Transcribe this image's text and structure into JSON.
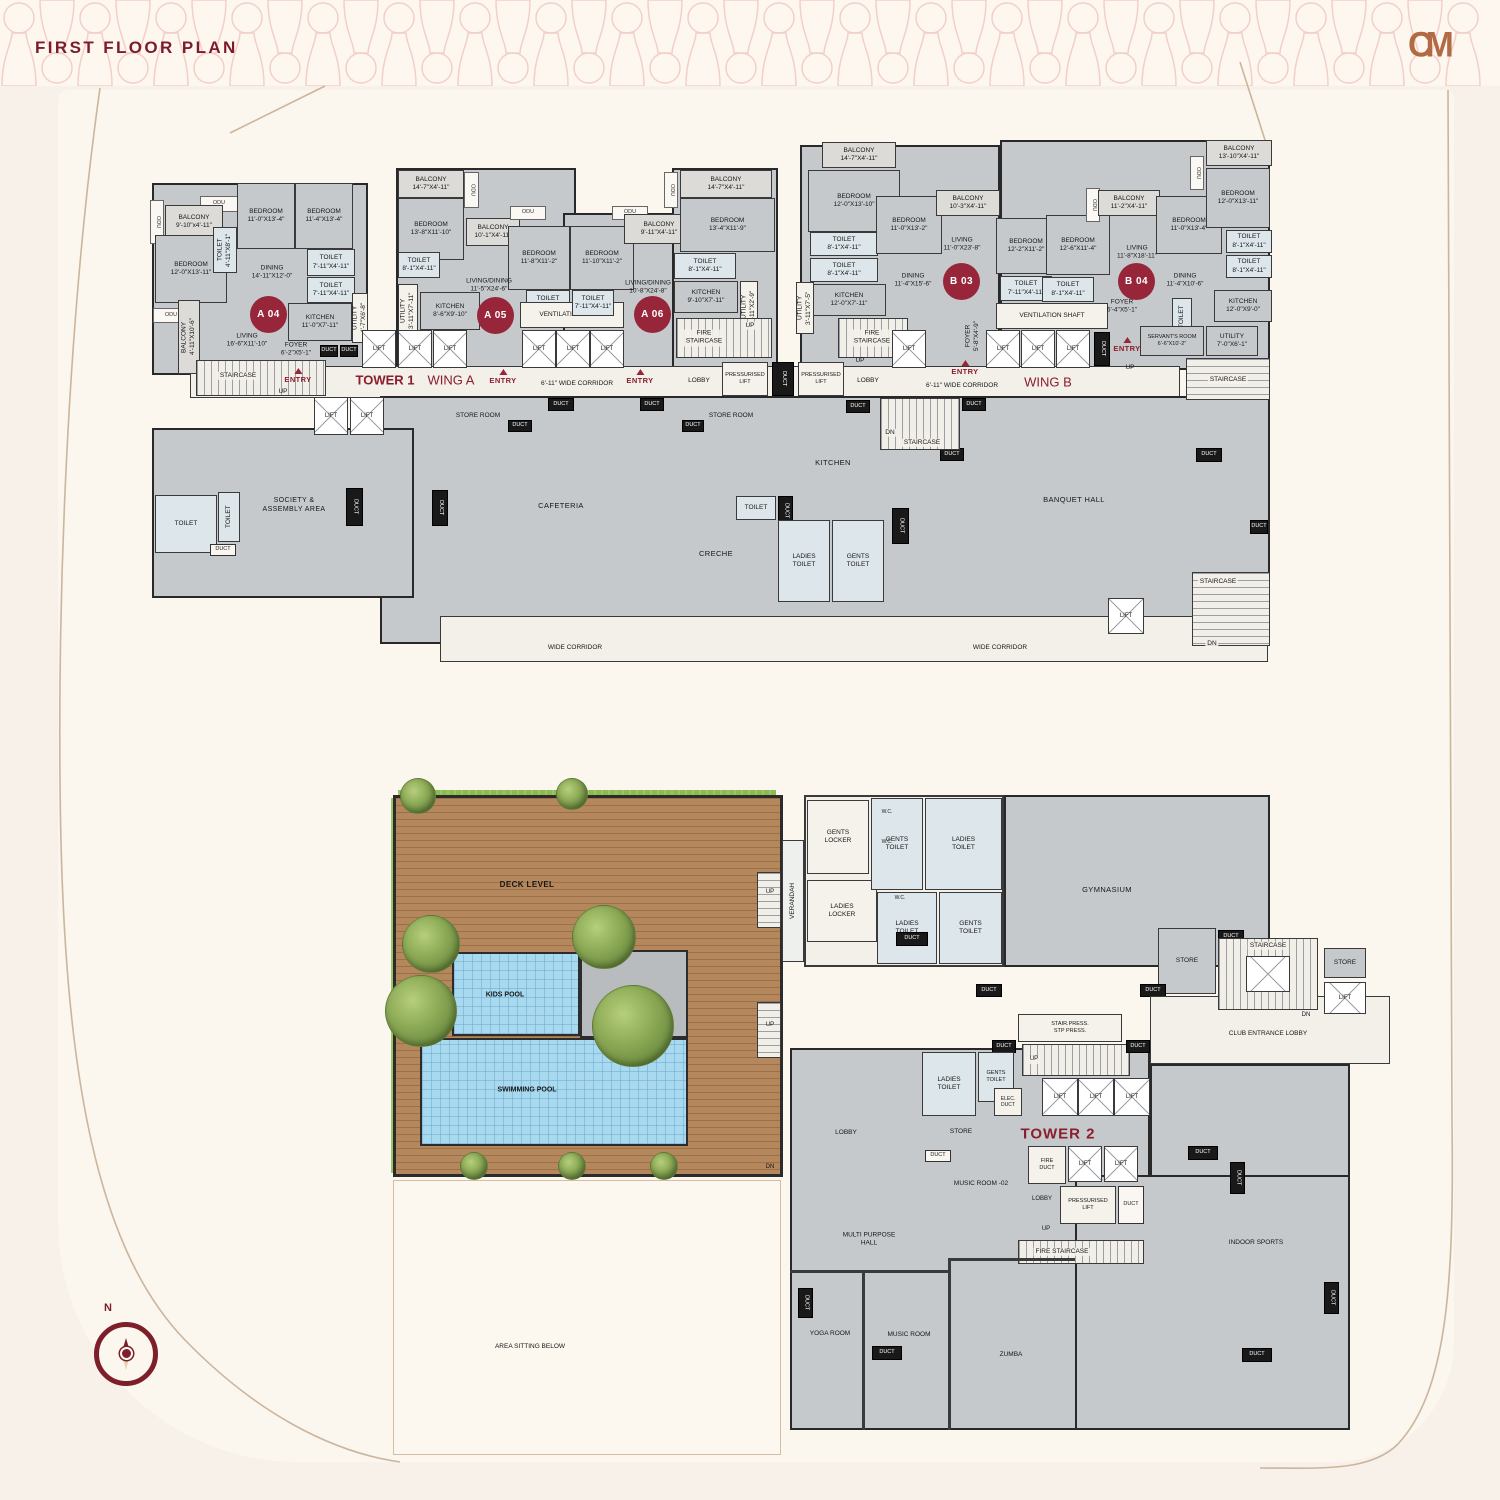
{
  "hdr": {
    "title": "FIRST FLOOR PLAN",
    "logo": "CM"
  },
  "badge": {
    "a04": "A 04",
    "a05": "A 05",
    "a06": "A 06",
    "b03": "B 03",
    "b04": "B 04"
  },
  "com": {
    "lift": "LIFT",
    "duct": "DUCT",
    "odu": "ODU",
    "entry": "ENTRY",
    "up": "UP",
    "dn": "DN",
    "staircase": "STAIRCASE",
    "toilet": "TOILET",
    "wc": "W.C.",
    "store": "STORE",
    "lobby": "LOBBY"
  },
  "t1": {
    "tower": "TOWER 1",
    "wing_a": "WING A",
    "wing_b": "WING B",
    "corridor": "6'-11\" WIDE CORRIDOR",
    "wide_corridor": "WIDE CORRIDOR",
    "vent": "VENTILATION SHAFT",
    "fire_stair": "FIRE\nSTAIRCASE",
    "press_lift": "PRESSURISED\nLIFT",
    "soc": "SOCIETY &\nASSEMBLY AREA",
    "store_room": "STORE ROOM",
    "cafeteria": "CAFETERIA",
    "kitchen": "KITCHEN",
    "creche": "CRECHE",
    "ladies_toilet": "LADIES\nTOILET",
    "gents_toilet": "GENTS\nTOILET",
    "banquet": "BANQUET HALL",
    "a04": {
      "bal1": "BALCONY\n9'-10\"x4'-11\"",
      "bed1": "BEDROOM\n11'-0\"X13'-4\"",
      "bed2": "BEDROOM\n11'-4\"X13'-4\"",
      "bed3": "BEDROOM\n12'-0\"X13'-11\"",
      "t1": "TOILET\n4'-11\"X8'-1\"",
      "t2": "TOILET\n7'-11\"X4'-11\"",
      "t3": "TOILET\n7'-11\"X4'-11\"",
      "dining": "DINING\n14'-11\"X12'-0\"",
      "kitchen": "KITCHEN\n11'-0\"X7'-11\"",
      "living": "LIVING\n16'-6\"X11'-10\"",
      "foyer": "FOYER\n6'-2\"X5'-1\"",
      "utility": "UTILITY\n4'-7\"X6'-8\"",
      "bal2": "BALCONY\n4'-11\"X10'-6\""
    },
    "a05": {
      "bal1": "BALCONY\n14'-7\"X4'-11\"",
      "bed1": "BEDROOM\n13'-8\"X11'-10\"",
      "t1": "TOILET\n8'-1\"X4'-11\"",
      "bal2": "BALCONY\n10'-1\"X4'-11\"",
      "bed2": "BEDROOM\n11'-8\"X11'-2\"",
      "t2": "TOILET\n7'-11\"X4'-11\"",
      "ld": "LIVING/DINING\n11'-5\"X24'-6\"",
      "kitchen": "KITCHEN\n8'-6\"X9'-10\"",
      "utility": "UTILITY\n3'-11\"X7'-11\""
    },
    "a06": {
      "bed1": "BEDROOM\n11'-10\"X11'-2\"",
      "t1": "TOILET\n7'-11\"X4'-11\"",
      "bal1": "BALCONY\n9'-11\"X4'-11\"",
      "ld": "LIVING/DINING\n10'-8\"X24'-8\"",
      "kitchen": "KITCHEN\n9'-10\"X7'-11\"",
      "t2": "TOILET\n8'-1\"X4'-11\"",
      "utility": "UTILITY\n3'-11\"X2'-9\"",
      "bal2": "BALCONY\n14'-7\"X4'-11\"",
      "bed2": "BEDROOM\n13'-4\"X11'-9\""
    },
    "b03": {
      "bal1": "BALCONY\n14'-7\"X4'-11\"",
      "bed1": "BEDROOM\n12'-0\"X13'-10\"",
      "t1": "TOILET\n8'-1\"X4'-11\"",
      "t2": "TOILET\n8'-1\"X4'-11\"",
      "kitchen": "KITCHEN\n12'-0\"X7'-11\"",
      "utility": "UTILITY\n3'-11\"X7'-5\"",
      "bed2": "BEDROOM\n11'-0\"X13'-2\"",
      "dining": "DINING\n11'-4\"X15'-6\"",
      "living": "LIVING\n11'-0\"X23'-8\"",
      "bal2": "BALCONY\n10'-3\"X4'-11\"",
      "foyer": "FOYER\n5'-8\"X4'-9\"",
      "bed3": "BEDROOM\n12'-2\"X11'-2\"",
      "t3": "TOILET\n7'-11\"X4'-11\""
    },
    "b04": {
      "bed1": "BEDROOM\n12'-6\"X11'-4\"",
      "t1": "TOILET\n8'-1\"X4'-11\"",
      "bal1": "BALCONY\n11'-2\"X4'-11\"",
      "living": "LIVING\n11'-8\"X18'-11\"",
      "bed3": "BEDROOM\n11'-0\"X13'-4\"",
      "dining": "DINING\n11'-4\"X10'-6\"",
      "foyer": "FOYER\n6'-4\"X5'-1\"",
      "bal2": "BALCONY\n13'-10\"X4'-11\"",
      "bed4": "BEDROOM\n12'-0\"X13'-11\"",
      "t3": "TOILET\n8'-1\"X4'-11\"",
      "t4": "TOILET\n8'-1\"X4'-11\"",
      "kitchen": "KITCHEN\n12'-0\"X9'-0\"",
      "servant": "SERVANT'S ROOM\n6'-6\"X10'-2\"",
      "utility": "UTILITY\n7'-0\"X6'-1\""
    }
  },
  "am": {
    "deck": "DECK LEVEL",
    "kids_pool": "KIDS  POOL",
    "swimming_pool": "SWIMMING  POOL",
    "verandah": "VERANDAH",
    "gents_locker": "GENTS\nLOCKER",
    "ladies_locker": "LADIES\nLOCKER",
    "gents_toilet": "GENTS\nTOILET",
    "ladies_toilet": "LADIES\nTOILET",
    "gym": "GYMNASIUM",
    "club": "CLUB ENTRANCE LOBBY",
    "stair_press": "STAIR.PRESS.\nSTP PRESS.",
    "elec_duct": "ELEC.\nDUCT",
    "tower2": "TOWER 2",
    "music2": "MUSIC ROOM -02",
    "fire_duct": "FIRE\nDUCT",
    "press_lift": "PRESSURISED\nLIFT",
    "fire_stair": "FIRE STAIRCASE",
    "mph": "MULTI PURPOSE\nHALL",
    "yoga": "YOGA ROOM",
    "music": "MUSIC ROOM",
    "zumba": "ZUMBA",
    "indoor": "INDOOR  SPORTS",
    "area_sitting": "AREA SITTING BELOW"
  },
  "compass": {
    "n": "N"
  },
  "colors": {
    "accent_maroon": "#8a1e2d",
    "badge": "#97263a",
    "copper": "#b26a45",
    "deck": "#b5875c",
    "pool": "#a9d9ee"
  }
}
